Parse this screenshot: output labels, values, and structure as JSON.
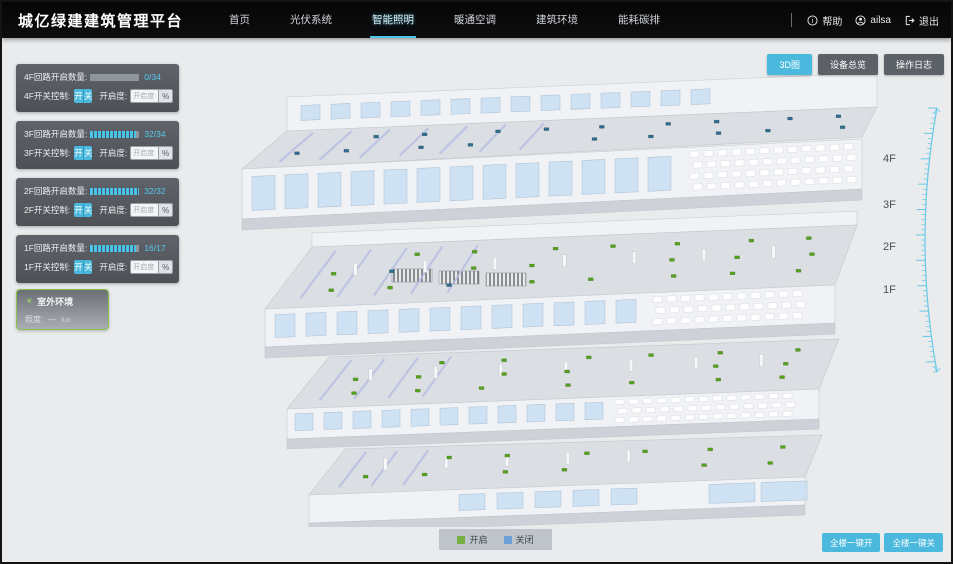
{
  "app": {
    "title": "城亿绿建建筑管理平台"
  },
  "nav": {
    "items": [
      {
        "label": "首页"
      },
      {
        "label": "光伏系统"
      },
      {
        "label": "智能照明",
        "active": true
      },
      {
        "label": "暖通空调"
      },
      {
        "label": "建筑环境"
      },
      {
        "label": "能耗碳排"
      }
    ],
    "help": "帮助",
    "user": "ailsa",
    "logout": "退出"
  },
  "toolbar": {
    "buttons": [
      {
        "label": "3D图",
        "active": true
      },
      {
        "label": "设备总览",
        "active": false
      },
      {
        "label": "操作日志",
        "active": false
      }
    ]
  },
  "floor_panels": [
    {
      "floor": "4F",
      "count_label": "4F回路开启数量:",
      "value": "0/34",
      "percent_css": "0%",
      "switch_label": "4F开关控制:",
      "on_label": "开",
      "off_label": "关",
      "dim_label": "开启度:",
      "dim_placeholder": "开启度",
      "unit": "%"
    },
    {
      "floor": "3F",
      "count_label": "3F回路开启数量:",
      "value": "32/34",
      "percent_css": "94%",
      "switch_label": "3F开关控制:",
      "on_label": "开",
      "off_label": "关",
      "dim_label": "开启度:",
      "dim_placeholder": "开启度",
      "unit": "%"
    },
    {
      "floor": "2F",
      "count_label": "2F回路开启数量:",
      "value": "32/32",
      "percent_css": "100%",
      "switch_label": "2F开关控制:",
      "on_label": "开",
      "off_label": "关",
      "dim_label": "开启度:",
      "dim_placeholder": "开启度",
      "unit": "%"
    },
    {
      "floor": "1F",
      "count_label": "1F回路开启数量:",
      "value": "16/17",
      "percent_css": "94%",
      "switch_label": "1F开关控制:",
      "on_label": "开",
      "off_label": "关",
      "dim_label": "开启度:",
      "dim_placeholder": "开启度",
      "unit": "%"
    }
  ],
  "outdoor": {
    "title": "室外环境",
    "metric_label": "照度:",
    "metric_value": "—",
    "metric_unit": "lux"
  },
  "floor_labels": {
    "f4": "4F",
    "f3": "3F",
    "f2": "2F",
    "f1": "1F"
  },
  "legend": {
    "on_label": "开启",
    "off_label": "关闭",
    "on_color": "#76b043",
    "off_color": "#6d9fd4"
  },
  "bulk_buttons": [
    {
      "label": "全楼一键开"
    },
    {
      "label": "全楼一键关"
    }
  ],
  "colors": {
    "accent": "#4ab9dd",
    "nav_bg": "#0a0a0a",
    "canvas_bg": "#e9ebed"
  }
}
